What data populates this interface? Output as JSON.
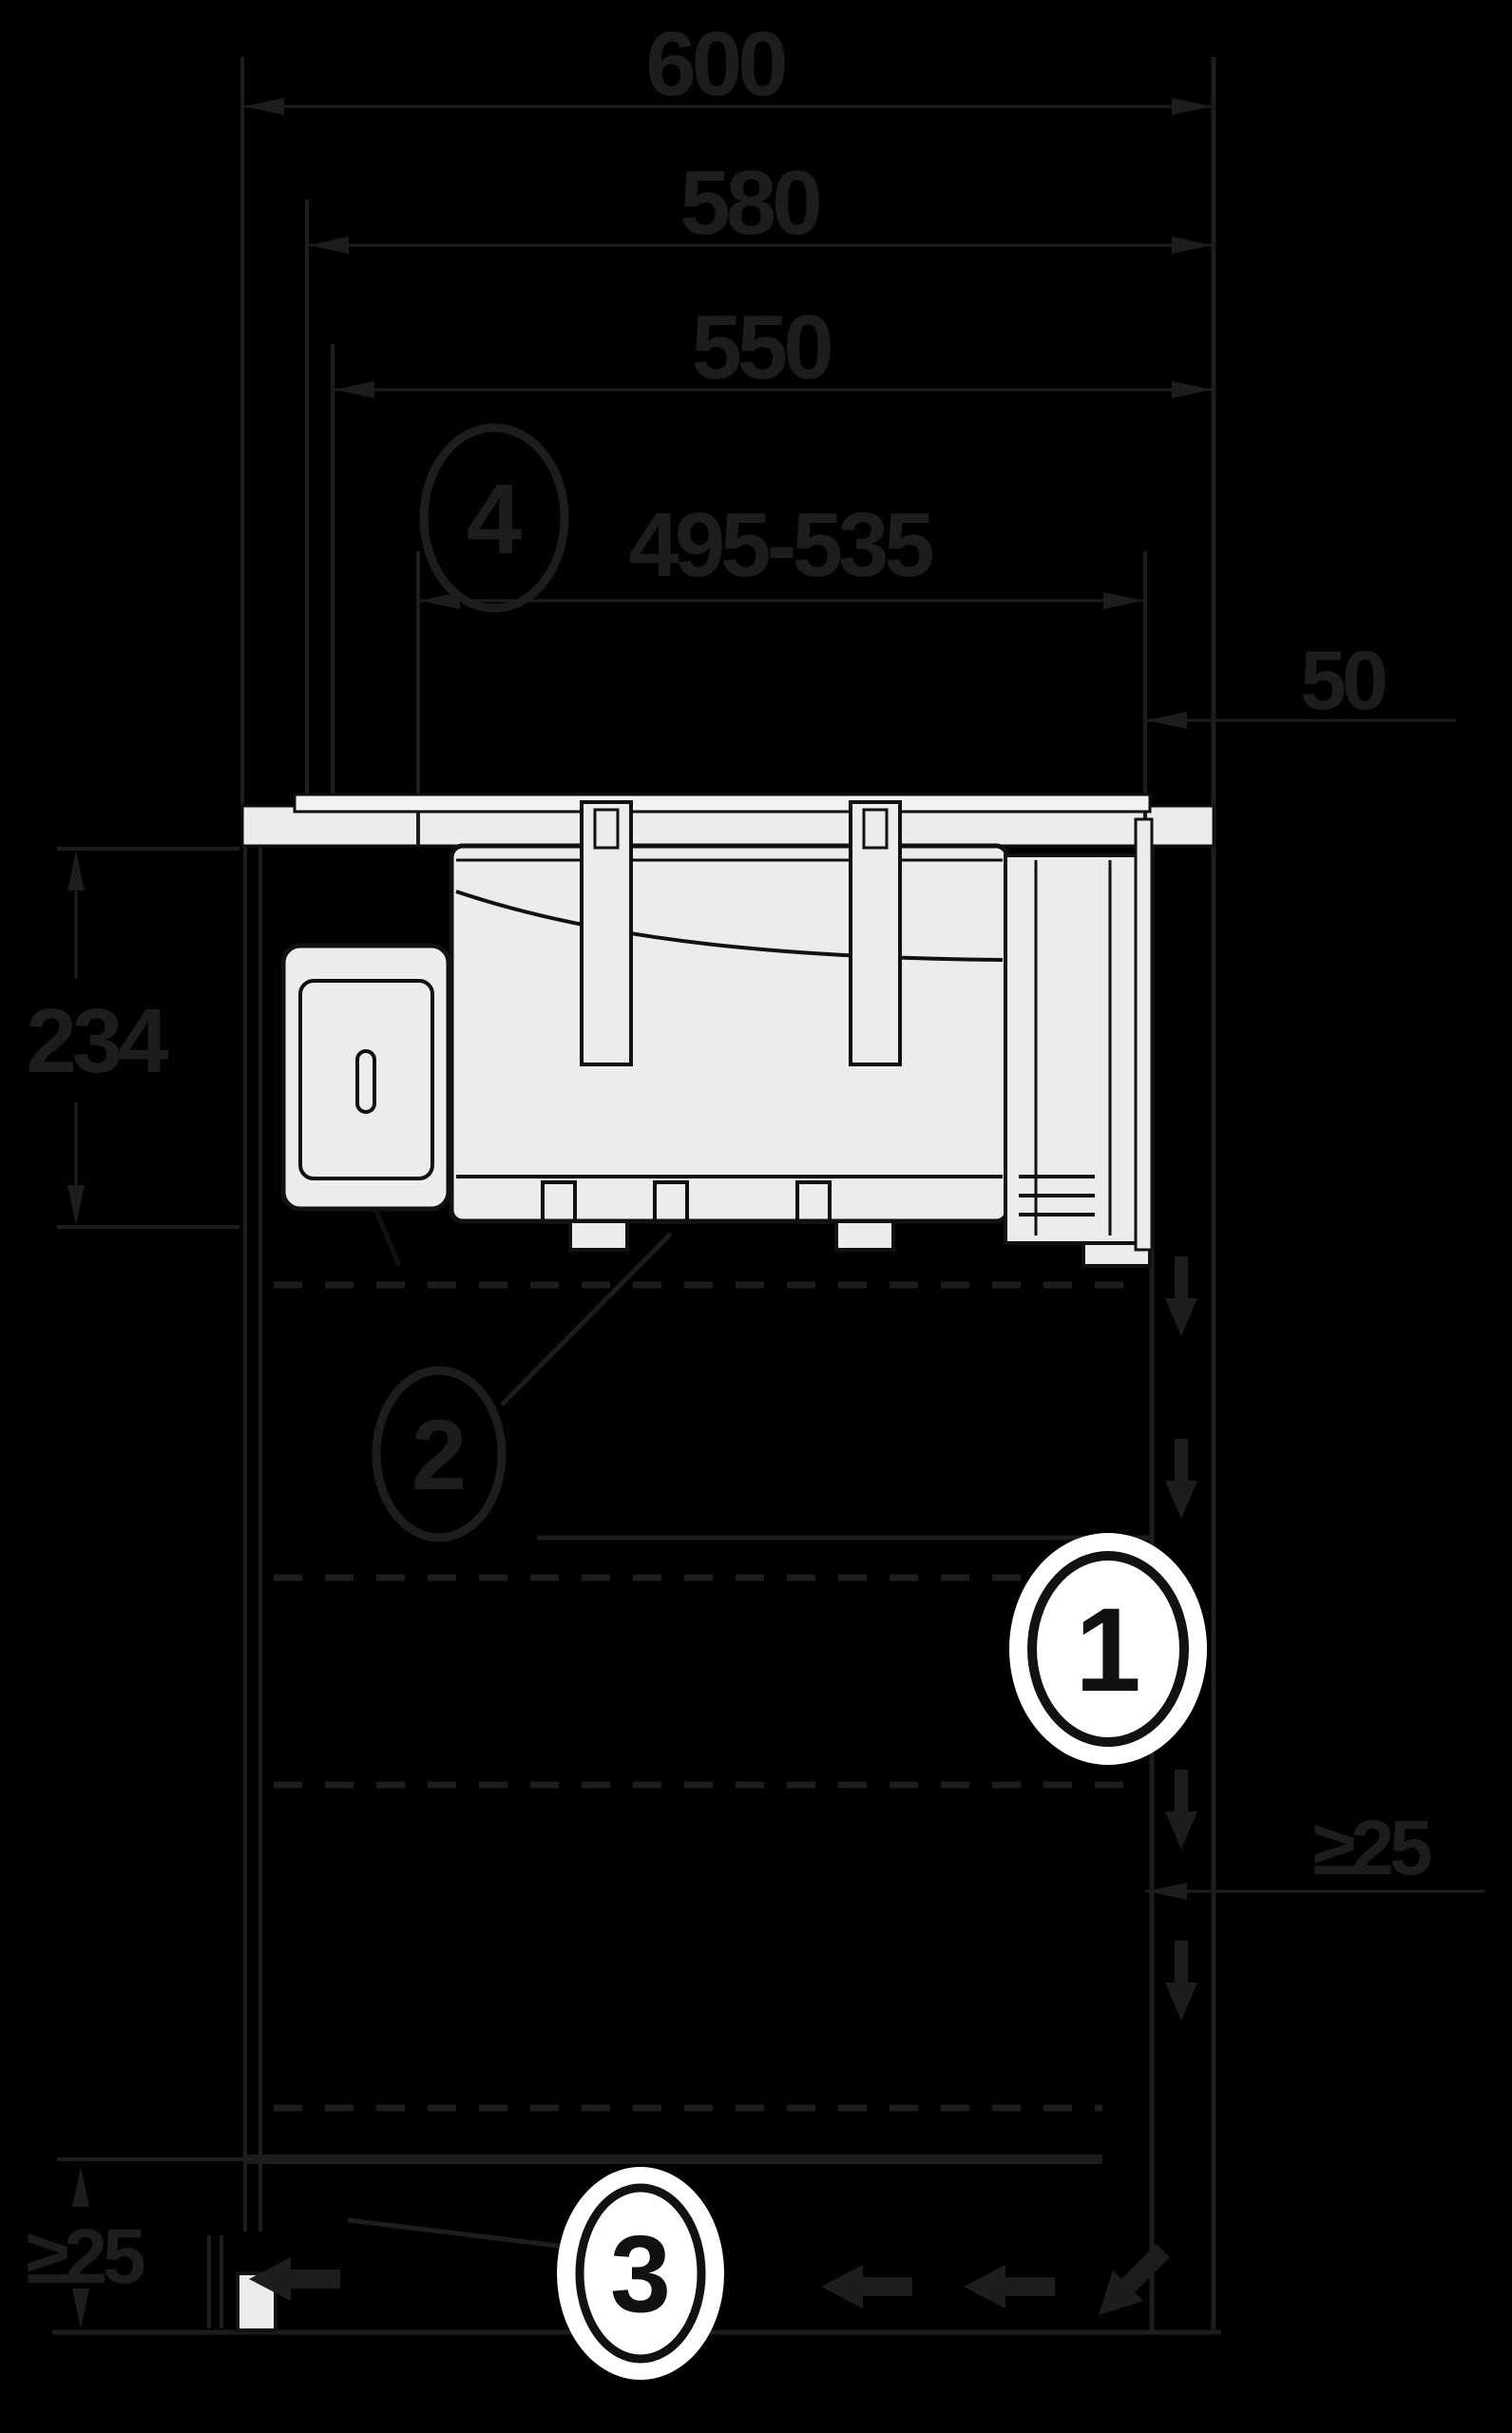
{
  "colors": {
    "background": "#000000",
    "line": "#1d1d1b",
    "appliance_fill": "#ececec",
    "glass_fill": "#f2f2f2",
    "callout_fill": "#ffffff",
    "callout_stroke": "#111111"
  },
  "dimensions": {
    "depth_total": {
      "label": "600"
    },
    "depth_cabinet": {
      "label": "580"
    },
    "depth_inner": {
      "label": "550"
    },
    "cutout_depth": {
      "label": "495-535"
    },
    "rear_gap": {
      "label": "50"
    },
    "appliance_height": {
      "label": "234"
    },
    "rear_clearance": {
      "label": "≥25"
    },
    "plinth_clearance": {
      "label": "≥25"
    }
  },
  "callouts": {
    "one": {
      "number": "1"
    },
    "two": {
      "number": "2"
    },
    "three": {
      "number": "3"
    },
    "four": {
      "number": "4"
    }
  },
  "icons": {
    "airflow_left": "left-arrow",
    "airflow_down": "down-arrow",
    "airflow_turn": "diagonal-down-left-arrow"
  }
}
